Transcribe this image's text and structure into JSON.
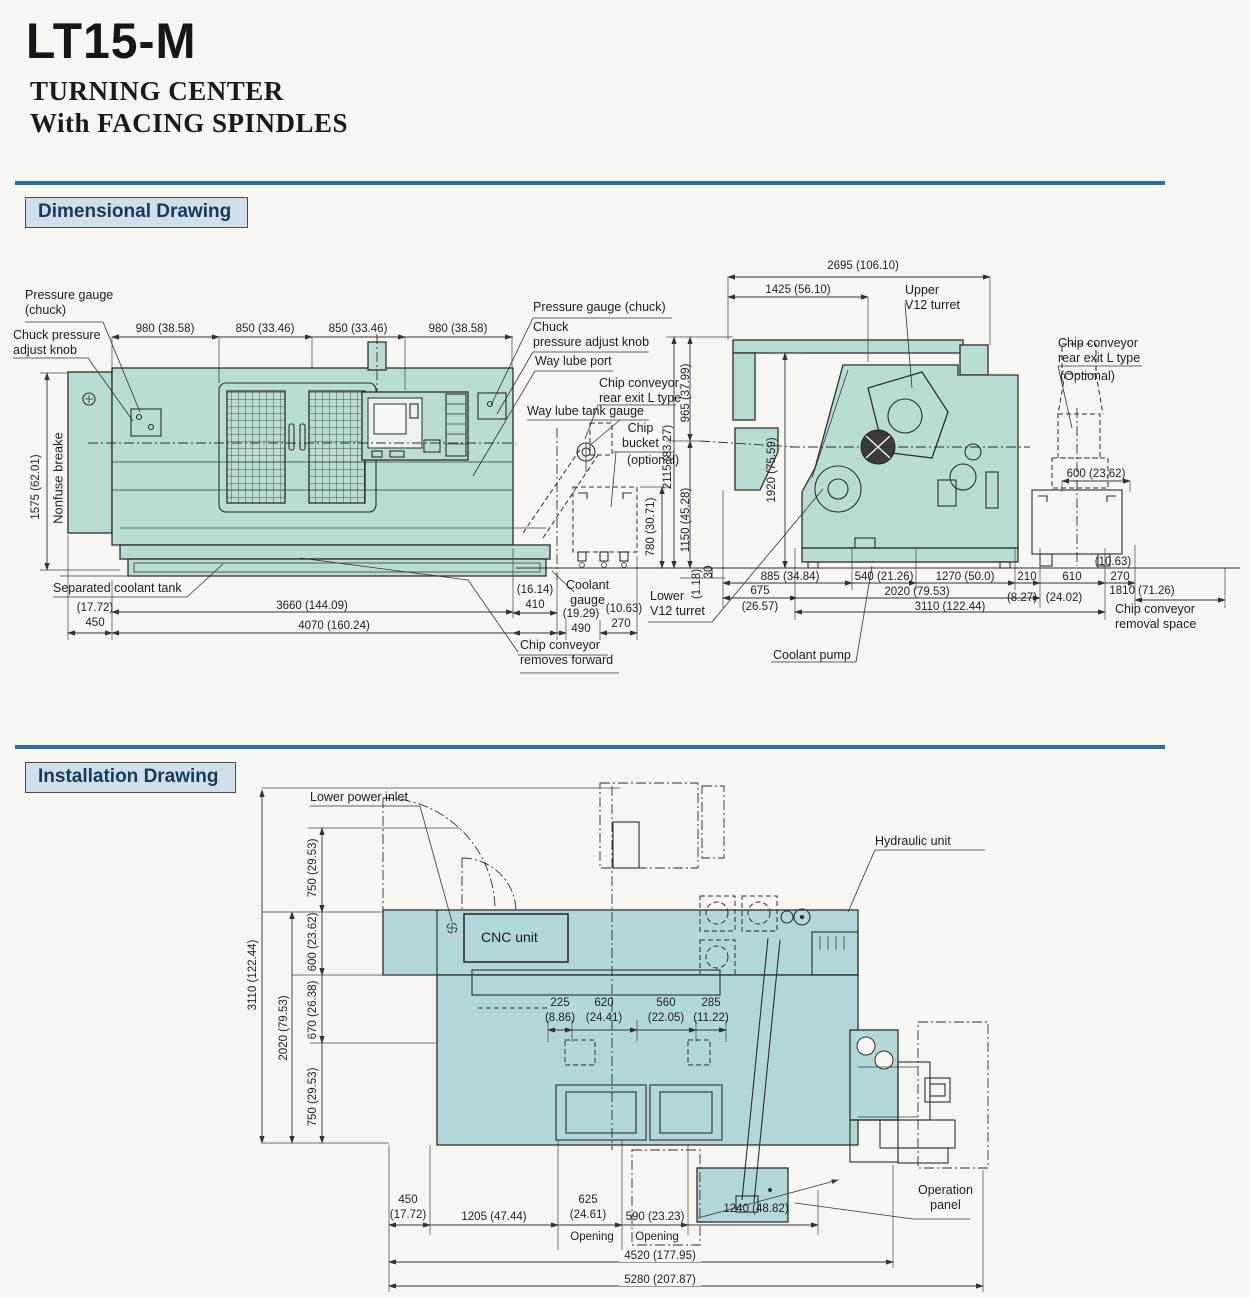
{
  "page": {
    "model": "LT15-M",
    "subtitle1": "TURNING CENTER",
    "subtitle2": "With FACING SPINDLES"
  },
  "sections": {
    "dimensional": "Dimensional Drawing",
    "installation": "Installation Drawing"
  },
  "colors": {
    "machine_fill": "#b9dcd5",
    "machine_fill2": "#b3d8da",
    "rule_blue": "#2c6da4",
    "header_bg": "#cfe0ea",
    "header_text": "#17395a"
  },
  "fv": {
    "label": {
      "pressure_gauge_left": "Pressure gauge\n(chuck)",
      "chuck_knob_left": "Chuck pressure\nadjust knob",
      "pressure_gauge_right": "Pressure gauge (chuck)",
      "chuck_knob_right": "Chuck\npressure adjust knob",
      "way_lube_port": "Way lube port",
      "chip_conveyor_rear": "Chip conveyor\nrear exit L type",
      "way_lube_tank_gauge": "Way lube tank gauge",
      "chip_bucket": "Chip\nbucket",
      "chip_bucket_note": "(optional)",
      "nonfuse_breaker": "Nonfuse breake",
      "separated_coolant_tank": "Separated coolant tank",
      "coolant_gauge": "Coolant\ngauge",
      "chip_conveyor_forward": "Chip conveyor\nremoves forward"
    },
    "dim": {
      "w1": "980 (38.58)",
      "w2": "850 (33.46)",
      "w3": "850 (33.46)",
      "w4": "980 (38.58)",
      "height": "1575 (62.01)",
      "d450i": "(17.72)",
      "d450": "450",
      "d3660": "3660 (144.09)",
      "d4070": "4070 (160.24)",
      "d410i": "(16.14)",
      "d410": "410",
      "d490i": "(19.29)",
      "d490": "490",
      "d270i": "(10.63)",
      "d270": "270",
      "d780": "780 (30.71)"
    }
  },
  "sv": {
    "label": {
      "upper_turret": "Upper\nV12 turret",
      "chip_conveyor_rear": "Chip conveyor\nrear exit L type",
      "optional": "(Optional)",
      "lower_turret": "Lower\nV12 turret",
      "coolant_pump": "Coolant pump",
      "removal_space": "Chip conveyor\nremoval space"
    },
    "dim": {
      "d2695": "2695 (106.10)",
      "d1425": "1425 (56.10)",
      "d965": "965 (37.99)",
      "d2115": "2115 (83.27)",
      "d1920": "1920 (75.59)",
      "d1150": "1150 (45.28)",
      "d30i": "(1.18)",
      "d30": "30",
      "d600": "600 (23.62)",
      "d885": "885 (34.84)",
      "d540": "540 (21.26)",
      "d1270": "1270 (50.0)",
      "d210": "210",
      "d610": "610",
      "d270": "270",
      "d270i": "(10.63)",
      "d675": "675",
      "d675i": "(26.57)",
      "d2020": "2020 (79.53)",
      "d210i": "(8.27)",
      "d610i": "(24.02)",
      "d3110": "3110 (122.44)",
      "d1810": "1810 (71.26)"
    }
  },
  "iv": {
    "label": {
      "lower_power_inlet": "Lower power inlet",
      "hydraulic_unit": "Hydraulic unit",
      "cnc_unit": "CNC unit",
      "operation_panel": "Operation\npanel",
      "opening_left": "Opening",
      "opening_right": "Opening"
    },
    "dim": {
      "d3110": "3110 (122.44)",
      "d2020": "2020 (79.53)",
      "d750a": "750 (29.53)",
      "d600": "600 (23.62)",
      "d670": "670 (26.38)",
      "d750b": "750 (29.53)",
      "d225": "225",
      "d225i": "(8.86)",
      "d620": "620",
      "d620i": "(24.41)",
      "d560": "560",
      "d560i": "(22.05)",
      "d285": "285",
      "d285i": "(11.22)",
      "d450": "450",
      "d450i": "(17.72)",
      "d1205": "1205 (47.44)",
      "d625": "625",
      "d625i": "(24.61)",
      "d590": "590 (23.23)",
      "d1240": "1240 (48.82)",
      "d4520": "4520 (177.95)",
      "d5280": "5280 (207.87)"
    }
  }
}
